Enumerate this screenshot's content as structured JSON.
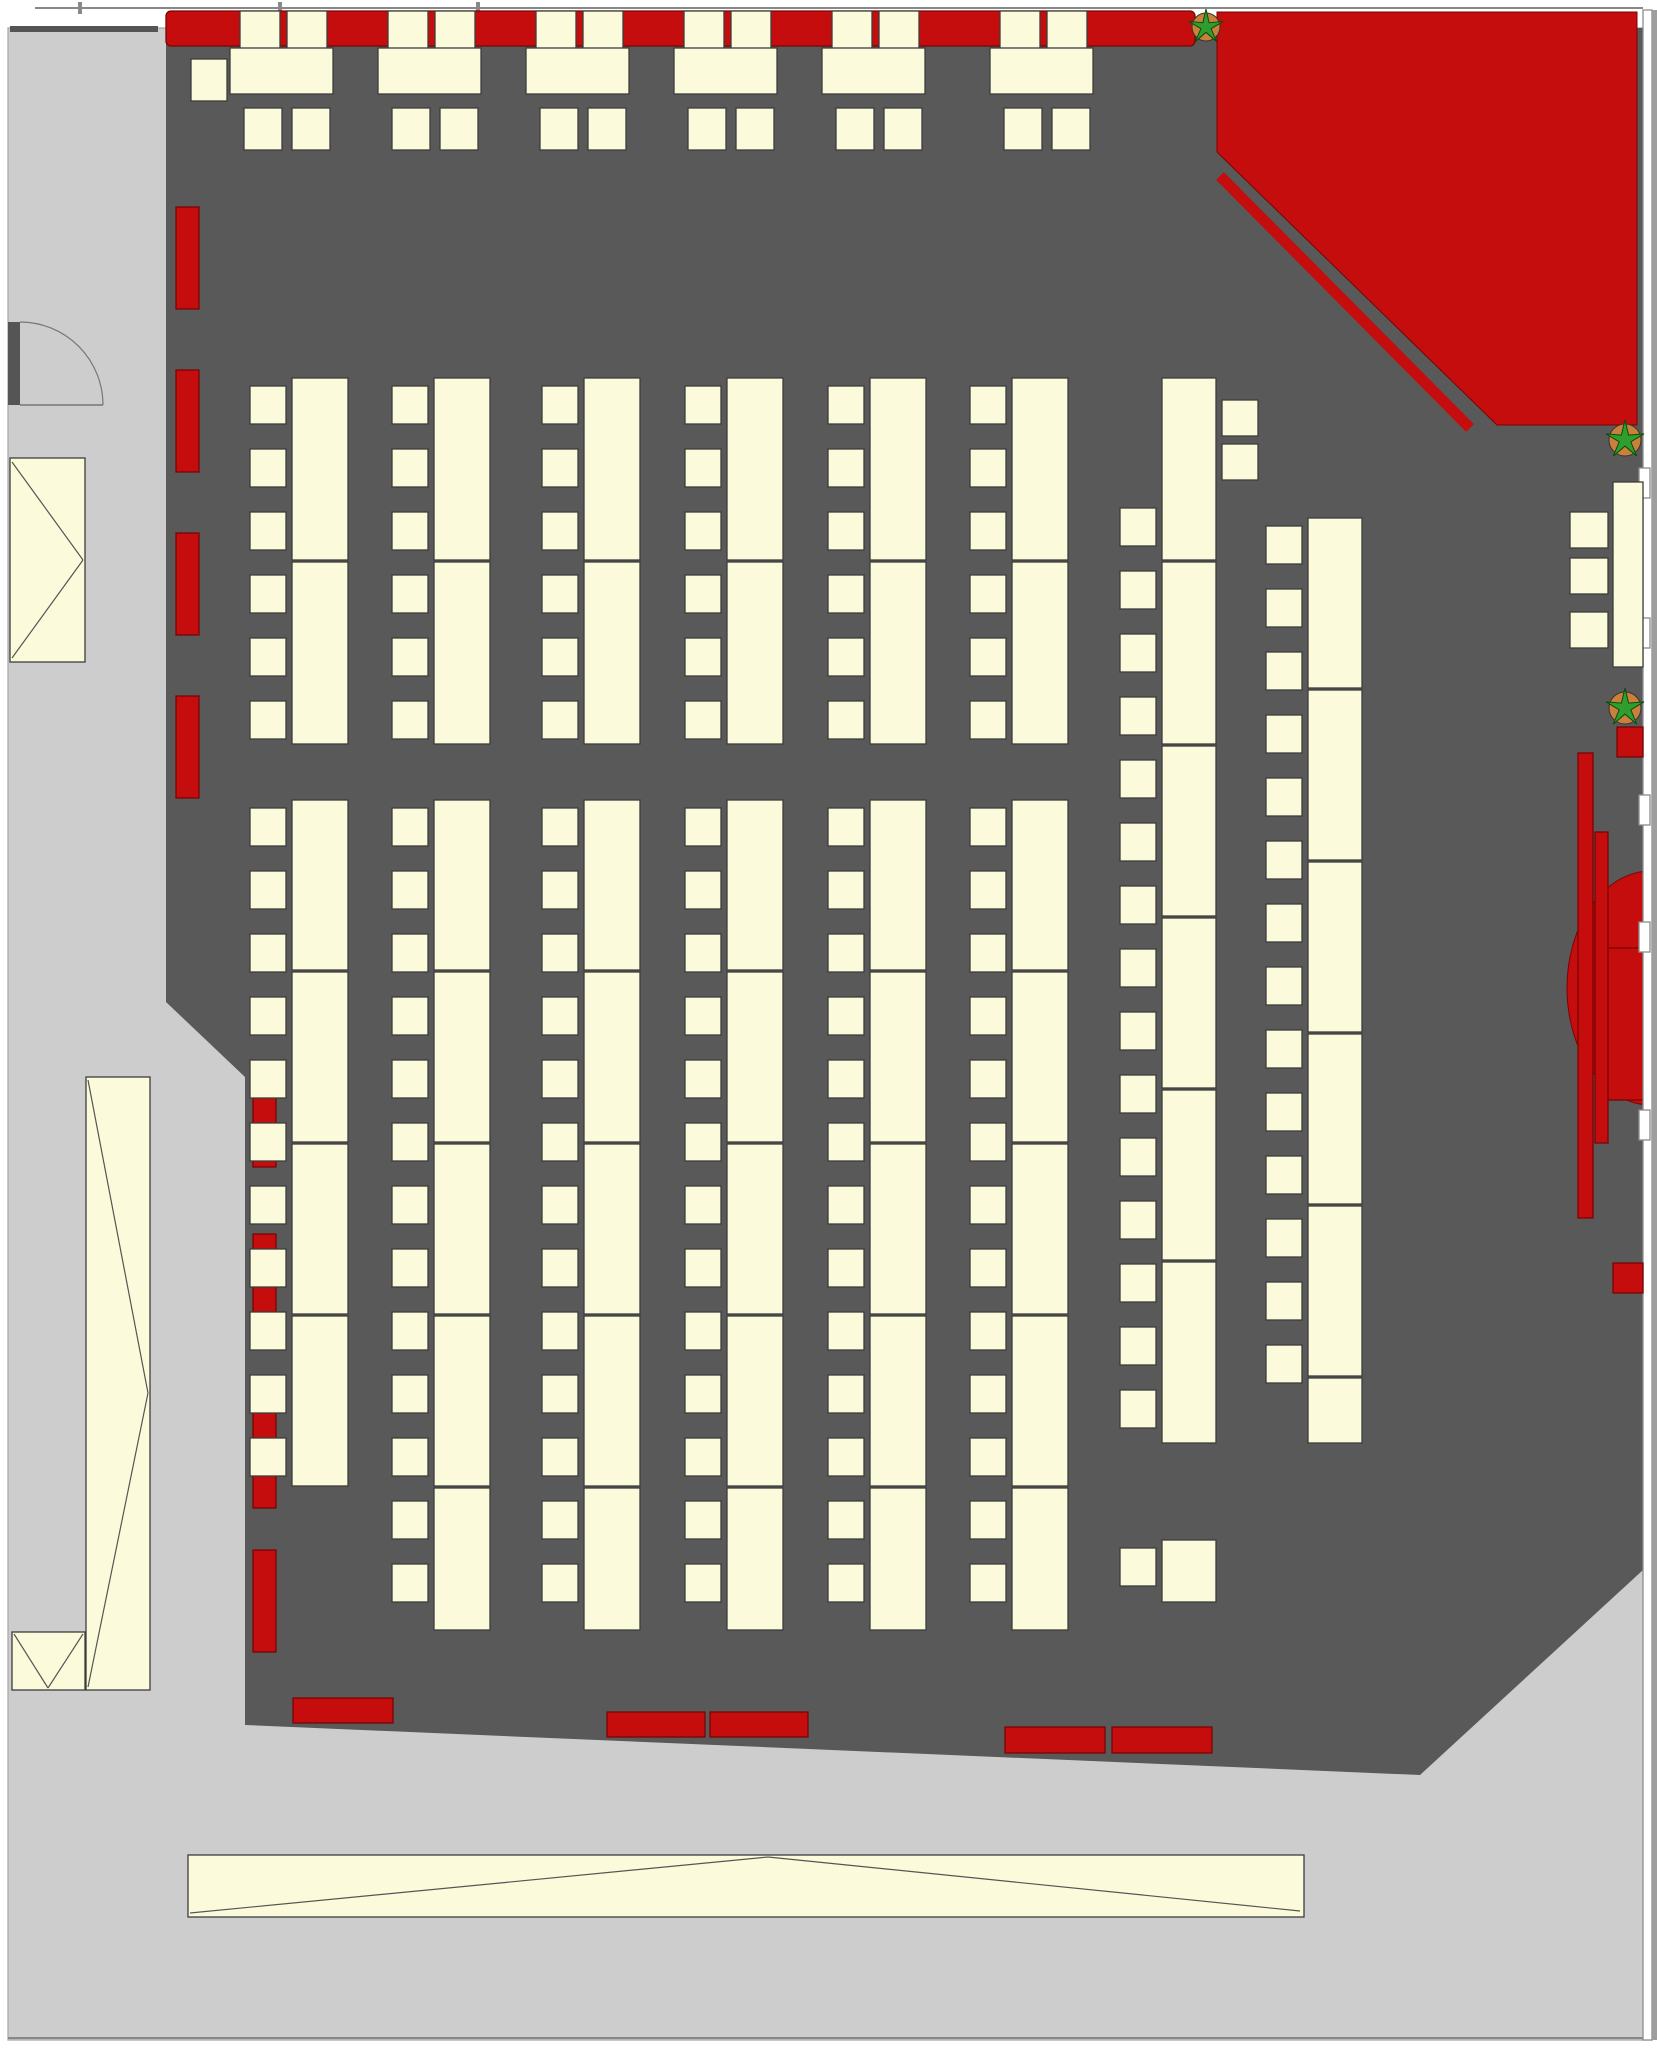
{
  "canvas": {
    "w": 1657,
    "h": 2050
  },
  "colors": {
    "floor_dark": "#595959",
    "floor_light": "#cdcdcd",
    "margin_strip": "#9e9e9e",
    "wall_white": "#ffffff",
    "wall_stroke": "#8c8c8c",
    "furniture_fill": "#FBFBDB",
    "furniture_stroke": "#3c3c3c",
    "red": "#C60D0D",
    "red_dark": "#7a0404",
    "plant_green": "#2f9e2f",
    "plant_green_dark": "#0a4a0a",
    "pot_orange": "#c9803a",
    "line": "#555555",
    "frame_line": "#888888",
    "jamb": "#555555"
  },
  "floors": {
    "light_rect": {
      "x": 8,
      "y": 28,
      "w": 1644,
      "h": 2012
    },
    "dark_polygon": [
      [
        166,
        28
      ],
      [
        1643,
        28
      ],
      [
        1643,
        1570
      ],
      [
        1420,
        1775
      ],
      [
        245,
        1725
      ],
      [
        245,
        1077
      ],
      [
        166,
        1002
      ]
    ]
  },
  "frame": {
    "top_line": {
      "x1": 35,
      "y1": 8,
      "x2": 1643,
      "y2": 8
    },
    "bottom_line": {
      "x1": 8,
      "y1": 2038,
      "x2": 1652,
      "y2": 2038
    },
    "ticks": [
      {
        "x": 78,
        "y": 2,
        "w": 4,
        "h": 12
      },
      {
        "x": 278,
        "y": 2,
        "w": 4,
        "h": 12
      },
      {
        "x": 476,
        "y": 2,
        "w": 4,
        "h": 12
      }
    ],
    "top_left_stub": {
      "x": 10,
      "y": 26,
      "w": 148,
      "h": 6
    }
  },
  "right_wall": {
    "band": {
      "x": 1643,
      "y": 10,
      "w": 9,
      "h": 2030
    },
    "strip": {
      "x": 1652,
      "y": 10,
      "w": 5,
      "h": 2030
    },
    "windows_x": 1639,
    "windows_w": 11,
    "windows_h": 30,
    "windows_ys": [
      468,
      618,
      795,
      922,
      1110
    ]
  },
  "red_corner": {
    "polygon": [
      [
        1217,
        12
      ],
      [
        1637,
        12
      ],
      [
        1637,
        425
      ],
      [
        1497,
        425
      ],
      [
        1217,
        152
      ]
    ],
    "rail": {
      "x1": 1220,
      "y1": 176,
      "x2": 1470,
      "y2": 428,
      "w": 11
    }
  },
  "stage_right": {
    "ellipse": {
      "cx": 1651,
      "cy": 988,
      "rx": 84,
      "ry": 117
    },
    "inner_rect": {
      "x": 1607,
      "y": 948,
      "w": 36,
      "h": 152
    },
    "bars": [
      {
        "x": 1578,
        "y": 753,
        "w": 15,
        "h": 465
      },
      {
        "x": 1595,
        "y": 832,
        "w": 13,
        "h": 311
      }
    ],
    "squares": [
      {
        "x": 1617,
        "y": 727,
        "w": 26,
        "h": 30
      },
      {
        "x": 1613,
        "y": 1263,
        "w": 30,
        "h": 30
      }
    ]
  },
  "top_row": {
    "bench": {
      "x": 166,
      "y": 11,
      "w": 1029,
      "h": 35
    },
    "tables_x": [
      230,
      378,
      526,
      674,
      822,
      990
    ],
    "table": {
      "y": 48,
      "w": 103,
      "h": 46
    },
    "bench_chair_offsets": [
      10,
      57
    ],
    "bench_chair": {
      "y": 11,
      "w": 40,
      "h": 38
    },
    "under_chair_offsets": [
      14,
      62
    ],
    "under_chair": {
      "y": 108,
      "w": 38,
      "h": 42
    },
    "side_chair": {
      "x": 191,
      "y": 59,
      "w": 36,
      "h": 42
    }
  },
  "left_bars_upper": {
    "x": 176,
    "w": 23,
    "h": 102,
    "ys": [
      207,
      370,
      533,
      696
    ]
  },
  "left_bars_lower": {
    "x": 253,
    "w": 23,
    "h": 102,
    "ys": [
      1065,
      1234,
      1406,
      1550
    ]
  },
  "bottom_benches": [
    {
      "x": 293,
      "y": 1698,
      "w": 100,
      "h": 25
    },
    {
      "x": 607,
      "y": 1712,
      "w": 98,
      "h": 25
    },
    {
      "x": 710,
      "y": 1712,
      "w": 98,
      "h": 25
    },
    {
      "x": 1005,
      "y": 1727,
      "w": 100,
      "h": 26
    },
    {
      "x": 1112,
      "y": 1727,
      "w": 100,
      "h": 26
    }
  ],
  "columns": [
    {
      "tx": 292,
      "tw": 56,
      "segs": [
        [
          378,
          560
        ],
        [
          562,
          744
        ]
      ],
      "cx": 250,
      "cw": 36,
      "ch": 38,
      "cys": [
        386,
        449,
        512,
        575,
        638,
        701
      ]
    },
    {
      "tx": 434,
      "tw": 56,
      "segs": [
        [
          378,
          560
        ],
        [
          562,
          744
        ]
      ],
      "cx": 392,
      "cw": 36,
      "ch": 38,
      "cys": [
        386,
        449,
        512,
        575,
        638,
        701
      ]
    },
    {
      "tx": 584,
      "tw": 56,
      "segs": [
        [
          378,
          560
        ],
        [
          562,
          744
        ]
      ],
      "cx": 542,
      "cw": 36,
      "ch": 38,
      "cys": [
        386,
        449,
        512,
        575,
        638,
        701
      ]
    },
    {
      "tx": 727,
      "tw": 56,
      "segs": [
        [
          378,
          560
        ],
        [
          562,
          744
        ]
      ],
      "cx": 685,
      "cw": 36,
      "ch": 38,
      "cys": [
        386,
        449,
        512,
        575,
        638,
        701
      ]
    },
    {
      "tx": 870,
      "tw": 56,
      "segs": [
        [
          378,
          560
        ],
        [
          562,
          744
        ]
      ],
      "cx": 828,
      "cw": 36,
      "ch": 38,
      "cys": [
        386,
        449,
        512,
        575,
        638,
        701
      ]
    },
    {
      "tx": 1012,
      "tw": 56,
      "segs": [
        [
          378,
          560
        ],
        [
          562,
          744
        ]
      ],
      "cx": 970,
      "cw": 36,
      "ch": 38,
      "cys": [
        386,
        449,
        512,
        575,
        638,
        701
      ]
    },
    {
      "tx": 292,
      "tw": 56,
      "segs": [
        [
          800,
          970
        ],
        [
          972,
          1142
        ],
        [
          1144,
          1314
        ],
        [
          1316,
          1486
        ]
      ],
      "cx": 250,
      "cw": 36,
      "ch": 38,
      "cys": [
        808,
        871,
        934,
        997,
        1060,
        1123,
        1186,
        1249,
        1312,
        1375,
        1438
      ]
    },
    {
      "tx": 434,
      "tw": 56,
      "segs": [
        [
          800,
          970
        ],
        [
          972,
          1142
        ],
        [
          1144,
          1314
        ],
        [
          1316,
          1486
        ],
        [
          1488,
          1630
        ]
      ],
      "cx": 392,
      "cw": 36,
      "ch": 38,
      "cys": [
        808,
        871,
        934,
        997,
        1060,
        1123,
        1186,
        1249,
        1312,
        1375,
        1438,
        1501,
        1564
      ]
    },
    {
      "tx": 584,
      "tw": 56,
      "segs": [
        [
          800,
          970
        ],
        [
          972,
          1142
        ],
        [
          1144,
          1314
        ],
        [
          1316,
          1486
        ],
        [
          1488,
          1630
        ]
      ],
      "cx": 542,
      "cw": 36,
      "ch": 38,
      "cys": [
        808,
        871,
        934,
        997,
        1060,
        1123,
        1186,
        1249,
        1312,
        1375,
        1438,
        1501,
        1564
      ]
    },
    {
      "tx": 727,
      "tw": 56,
      "segs": [
        [
          800,
          970
        ],
        [
          972,
          1142
        ],
        [
          1144,
          1314
        ],
        [
          1316,
          1486
        ],
        [
          1488,
          1630
        ]
      ],
      "cx": 685,
      "cw": 36,
      "ch": 38,
      "cys": [
        808,
        871,
        934,
        997,
        1060,
        1123,
        1186,
        1249,
        1312,
        1375,
        1438,
        1501,
        1564
      ]
    },
    {
      "tx": 870,
      "tw": 56,
      "segs": [
        [
          800,
          970
        ],
        [
          972,
          1142
        ],
        [
          1144,
          1314
        ],
        [
          1316,
          1486
        ],
        [
          1488,
          1630
        ]
      ],
      "cx": 828,
      "cw": 36,
      "ch": 38,
      "cys": [
        808,
        871,
        934,
        997,
        1060,
        1123,
        1186,
        1249,
        1312,
        1375,
        1438,
        1501,
        1564
      ]
    },
    {
      "tx": 1012,
      "tw": 56,
      "segs": [
        [
          800,
          970
        ],
        [
          972,
          1142
        ],
        [
          1144,
          1314
        ],
        [
          1316,
          1486
        ],
        [
          1488,
          1630
        ]
      ],
      "cx": 970,
      "cw": 36,
      "ch": 38,
      "cys": [
        808,
        871,
        934,
        997,
        1060,
        1123,
        1186,
        1249,
        1312,
        1375,
        1438,
        1501,
        1564
      ]
    },
    {
      "tx": 1162,
      "tw": 54,
      "segs": [
        [
          378,
          560
        ],
        [
          562,
          744
        ],
        [
          746,
          916
        ],
        [
          918,
          1088
        ],
        [
          1090,
          1260
        ],
        [
          1262,
          1443
        ],
        [
          1540,
          1602
        ]
      ],
      "cx": 1120,
      "cw": 36,
      "ch": 38,
      "cys": [
        508,
        571,
        634,
        697,
        760,
        823,
        886,
        949,
        1012,
        1075,
        1138,
        1201,
        1264,
        1327,
        1390,
        1548
      ],
      "extra_right_chairs": {
        "x": 1222,
        "w": 36,
        "h": 36,
        "ys": [
          400,
          444
        ]
      }
    },
    {
      "tx": 1308,
      "tw": 54,
      "segs": [
        [
          518,
          688
        ],
        [
          690,
          860
        ],
        [
          862,
          1032
        ],
        [
          1034,
          1204
        ],
        [
          1206,
          1376
        ],
        [
          1378,
          1443
        ]
      ],
      "cx": 1266,
      "cw": 36,
      "ch": 38,
      "cys": [
        526,
        589,
        652,
        715,
        778,
        841,
        904,
        967,
        1030,
        1093,
        1156,
        1219,
        1282,
        1345
      ]
    }
  ],
  "right_wall_table": {
    "table": {
      "x": 1613,
      "y": 482,
      "w": 30,
      "h": 185
    },
    "chairs": {
      "x": 1570,
      "w": 38,
      "h": 36,
      "ys": [
        512,
        558,
        612
      ]
    }
  },
  "corridor": {
    "stairs_box": {
      "x": 10,
      "y": 458,
      "w": 75,
      "h": 204,
      "lines": [
        [
          12,
          462,
          83,
          560
        ],
        [
          83,
          560,
          12,
          658
        ]
      ]
    },
    "escalator_box": {
      "x": 86,
      "y": 1077,
      "w": 64,
      "h": 613,
      "lines": [
        [
          88,
          1080,
          148,
          1393
        ],
        [
          148,
          1393,
          88,
          1687
        ]
      ]
    },
    "v_box": {
      "x": 12,
      "y": 1632,
      "w": 73,
      "h": 58,
      "lines": [
        [
          14,
          1634,
          48,
          1688
        ],
        [
          48,
          1688,
          83,
          1634
        ]
      ]
    },
    "door": {
      "jamb": {
        "x": 8,
        "y": 322,
        "w": 12,
        "h": 83
      },
      "leaf": [
        20,
        405,
        103,
        405
      ],
      "arc": "M103,405 A83,83 0 0 0 20,322"
    },
    "long_table": {
      "x": 188,
      "y": 1855,
      "w": 1116,
      "h": 62,
      "lines": [
        [
          190,
          1913,
          768,
          1857
        ],
        [
          768,
          1857,
          1300,
          1911
        ]
      ]
    }
  },
  "plants": [
    {
      "cx": 1206,
      "cy": 27,
      "r": 14
    },
    {
      "cx": 1625,
      "cy": 440,
      "r": 16
    },
    {
      "cx": 1625,
      "cy": 708,
      "r": 16
    }
  ]
}
